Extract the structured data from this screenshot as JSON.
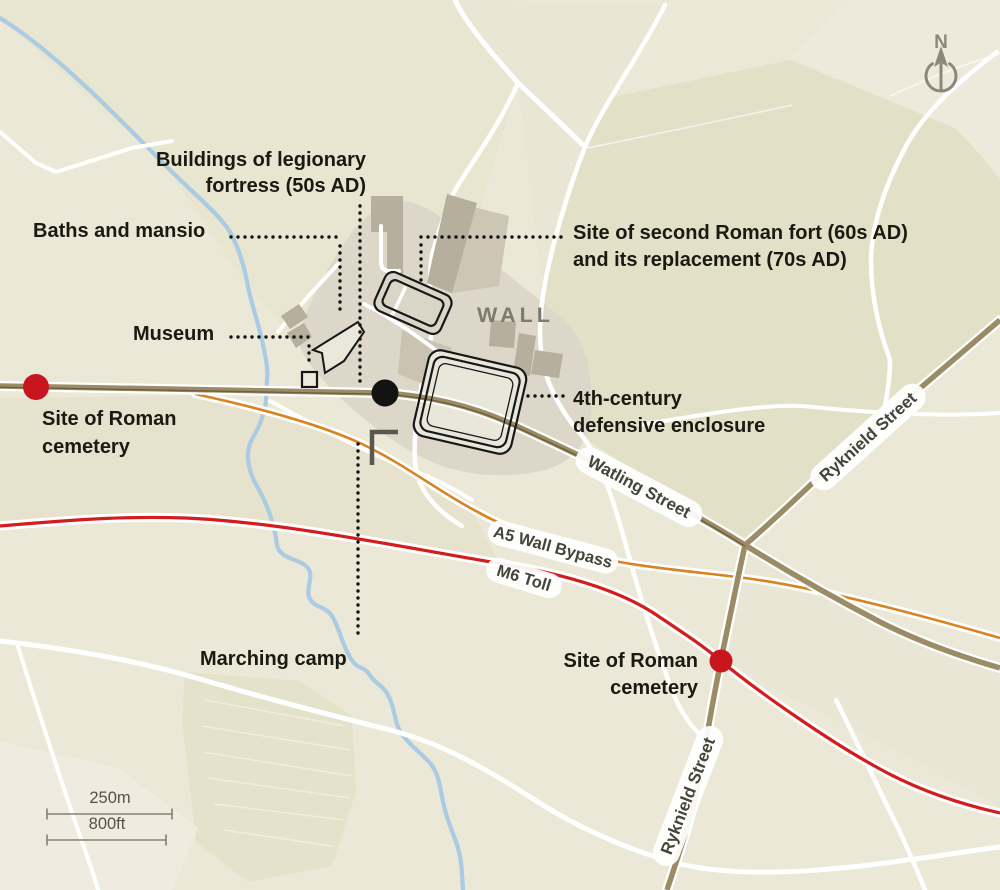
{
  "map": {
    "place_label": "WALL",
    "compass_label": "N",
    "annotations": {
      "legionary_fortress_line1": "Buildings of legionary",
      "legionary_fortress_line2": "fortress (50s AD)",
      "baths_mansio": "Baths and mansio",
      "museum": "Museum",
      "second_fort_line1": "Site of second Roman fort (60s AD)",
      "second_fort_line2": "and its replacement (70s AD)",
      "enclosure_line1": "4th-century",
      "enclosure_line2": "defensive enclosure",
      "cemetery_west_line1": "Site of Roman",
      "cemetery_west_line2": "cemetery",
      "cemetery_south_line1": "Site of Roman",
      "cemetery_south_line2": "cemetery",
      "marching_camp": "Marching camp"
    },
    "road_labels": {
      "watling": "Watling Street",
      "ryknield_ne": "Ryknield Street",
      "ryknield_s": "Ryknield Street",
      "a5_bypass": "A5 Wall Bypass",
      "m6_toll": "M6 Toll"
    },
    "scale_bar": {
      "metric": "250m",
      "imperial": "800ft"
    },
    "colors": {
      "background": "#ebe8d7",
      "roman_road": "#9c8c65",
      "roman_road_dark": "#6f5f3e",
      "a5_bypass_line": "#d9821f",
      "m6_toll_line": "#d41c1c",
      "marker_red": "#c9161e",
      "marker_black": "#131313",
      "stream_blue": "#aacbe2",
      "wall_label_gray": "#7e7b6e"
    }
  }
}
